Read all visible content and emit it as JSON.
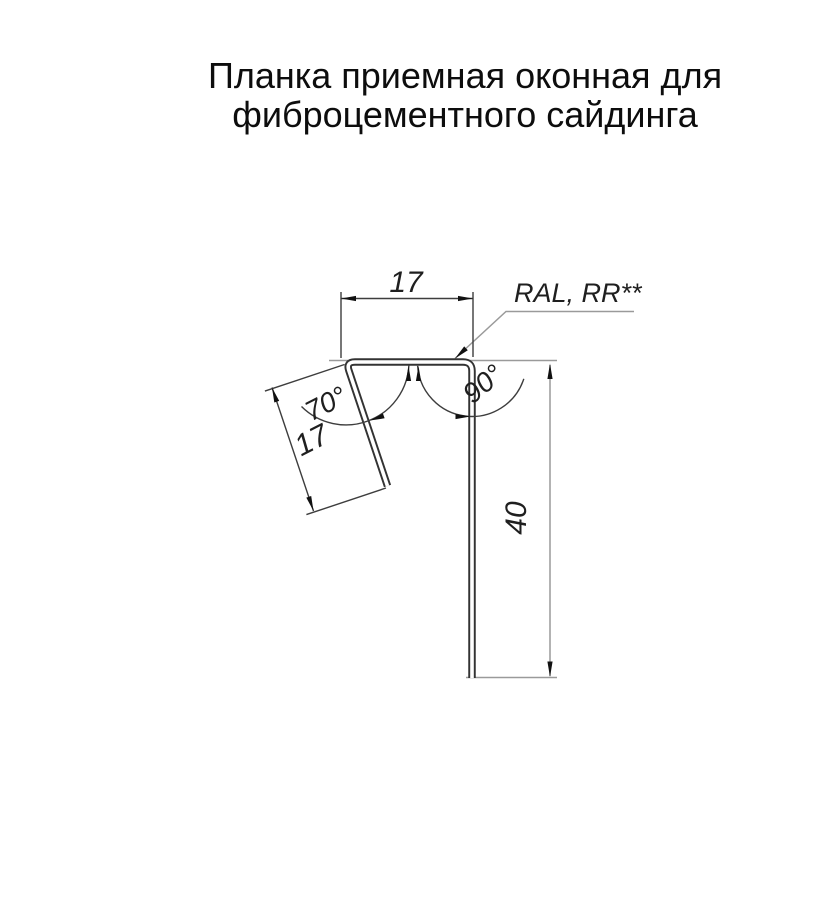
{
  "title": {
    "line1": "Планка приемная оконная для",
    "line2": "фиброцементного сайдинга"
  },
  "drawing": {
    "dim_top_width": "17",
    "dim_leg_length": "17",
    "dim_height": "40",
    "angle_left": "70°",
    "angle_right": "90°",
    "coating_label": "RAL, RR**"
  },
  "colors": {
    "background": "#ffffff",
    "profile_outline": "#333333",
    "dimension_lines": "#3d3d3d",
    "extension_lines": "#9a9a9a",
    "text": "#1f1f1f"
  }
}
